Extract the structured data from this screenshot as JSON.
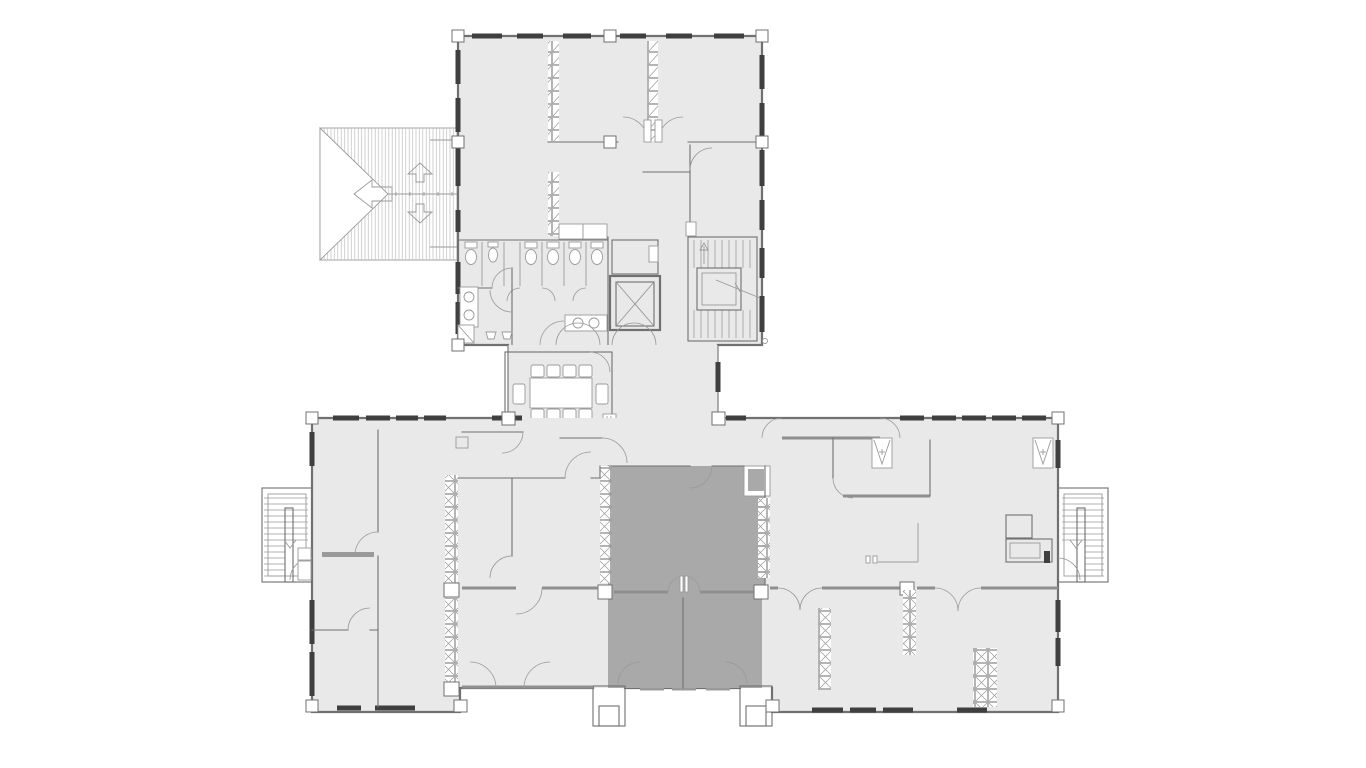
{
  "colors": {
    "background": "#ffffff",
    "floor": "#e9e9e9",
    "highlight": "#a9a9a9",
    "wall": "#707070",
    "wall_heavy": "#8f8f8f",
    "wall_light": "#9a9a9a",
    "window": "#3f3f3f",
    "hatch": "#bdbdbd"
  },
  "features": [
    "roof-terrace",
    "upper-office-wing",
    "restrooms",
    "elevator",
    "interior-stairwell",
    "conference-table",
    "corridor-link",
    "lower-office-wing",
    "highlighted-suite",
    "double-entry-doors",
    "exit-vestibules",
    "exterior-stair-left",
    "exterior-stair-right",
    "window-bands",
    "column-grid",
    "shaft-wall-partitions"
  ]
}
